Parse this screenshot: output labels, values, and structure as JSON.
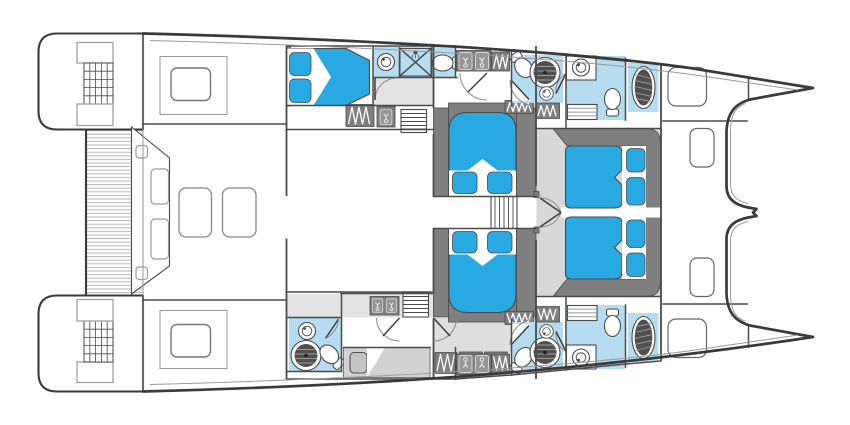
{
  "title": "catamaran-accommodation-floor-plan",
  "view": "top-down",
  "colors": {
    "hull": "#3a3a3a",
    "wall": "#4a4a4a",
    "lmid": "#9a9a9a",
    "bed": "#29a9e1",
    "bath": "#b5dcf0",
    "dk": "#7f7f7f",
    "flr": "#d8d8d8",
    "stripe": "#b6b6b6",
    "shower": "#4f4f4f",
    "berth": "#d2d2d2"
  },
  "rooms": [
    {
      "id": "swim-platform-port",
      "fixtures": [
        "teak-deck",
        "steps"
      ]
    },
    {
      "id": "swim-platform-starboard",
      "fixtures": [
        "teak-deck",
        "steps"
      ]
    },
    {
      "id": "aft-deck",
      "fixtures": [
        "teak-deck",
        "bench-seat",
        "seat-cushion",
        "seat-cushion"
      ]
    },
    {
      "id": "cockpit",
      "fixtures": [
        "seat",
        "seat",
        "skylight",
        "skylight"
      ]
    },
    {
      "id": "salon",
      "fixtures": []
    },
    {
      "id": "port-aft-cabin",
      "fixtures": [
        "double-bed",
        "pillow",
        "pillow",
        "wardrobe",
        "sink-cabinet"
      ]
    },
    {
      "id": "port-aft-bathroom",
      "fixtures": [
        "washbasin",
        "shower-stall",
        "toilet"
      ]
    },
    {
      "id": "port-corridor",
      "fixtures": [
        "vanity-basin",
        "vanity-basin",
        "wardrobe",
        "stairs"
      ]
    },
    {
      "id": "port-mid-bathroom",
      "fixtures": [
        "toilet",
        "round-shower",
        "washbasin",
        "wardrobe"
      ]
    },
    {
      "id": "port-bow-bathroom",
      "fixtures": [
        "washbasin",
        "toilet",
        "shelves",
        "oval-shower"
      ]
    },
    {
      "id": "mid-cabin-port",
      "fixtures": [
        "double-bed",
        "pillow",
        "pillow"
      ]
    },
    {
      "id": "mid-cabin-starboard",
      "fixtures": [
        "double-bed",
        "pillow",
        "pillow"
      ]
    },
    {
      "id": "center-stairs",
      "fixtures": [
        "stairs",
        "double-doors"
      ]
    },
    {
      "id": "owner-cabin",
      "fixtures": [
        "double-bed",
        "double-bed",
        "pillow",
        "pillow",
        "pillow",
        "pillow"
      ]
    },
    {
      "id": "starboard-aft-bathroom",
      "fixtures": [
        "washbasin",
        "round-shower",
        "toilet"
      ]
    },
    {
      "id": "starboard-aft-cabin",
      "fixtures": [
        "single-berth",
        "pillow"
      ]
    },
    {
      "id": "starboard-corridor",
      "fixtures": [
        "vanity-basin",
        "vanity-basin",
        "sink-cabinet",
        "sink-cabinet",
        "wardrobe",
        "stairs"
      ]
    },
    {
      "id": "starboard-mid-bathroom",
      "fixtures": [
        "toilet",
        "round-shower",
        "washbasin",
        "wardrobe"
      ]
    },
    {
      "id": "starboard-bow-bathroom",
      "fixtures": [
        "washbasin",
        "toilet",
        "shelves",
        "oval-shower"
      ]
    },
    {
      "id": "foredeck",
      "fixtures": [
        "hatch",
        "hatch",
        "hatch",
        "hatch"
      ]
    }
  ]
}
